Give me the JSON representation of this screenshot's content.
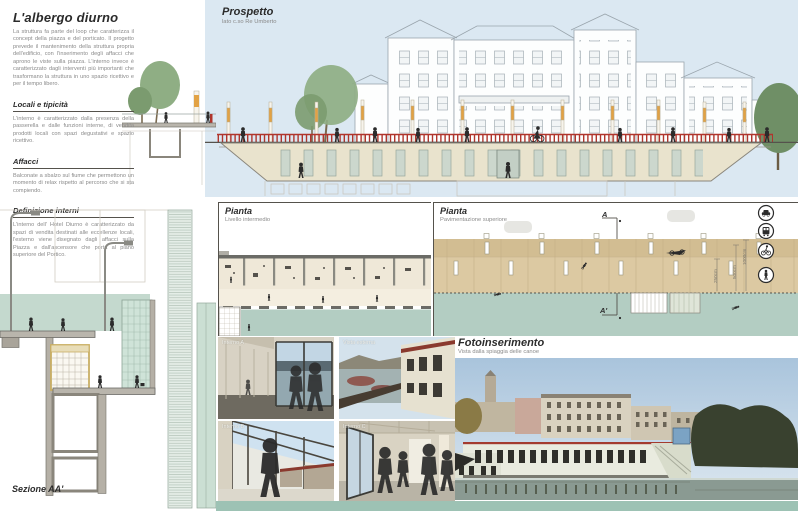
{
  "palette": {
    "sky": "#dbe8f2",
    "accent_red": "#b0352c",
    "deck_tan": "#d6c298",
    "building_beige": "#e9e3cd",
    "water_green": "#b3cdc2",
    "footer_teal": "#9dc2b4",
    "post_orange": "#e2a244",
    "silhouette": "#2b2b2b"
  },
  "left_column": {
    "title": "L'albergo diurno",
    "intro": "La struttura fa parte del loop che caratterizza il concept della piazza e del porticato. Il progetto prevede il mantenimento della struttura propria dell'edificio, con l'inserimento degli affacci che aprono le viste sulla piazza. L'interno invece è caratterizzato dagli interventi più importanti che trasformano la struttura in uno spazio ricettivo e per il tempo libero.",
    "sections": [
      {
        "heading": "Locali e tipicità",
        "body": "L'interno è caratterizzato dalla presenza della passerella e dalle funzioni interne, di vendita prodotti locali con spazi degustativi e spazio ricettivo."
      },
      {
        "heading": "Affacci",
        "body": "Balconate a sbalzo sul fiume che permettono un momento di relax rispetto al percorso che si sta compiendo."
      },
      {
        "heading": "Definizione interni",
        "body": "L'interno dell' Hotel Diurno è caratterizzato da spazi di vendita destinati alle eccellenze locali, l'esterno viene disegnato dagli affacci sulla Piazza e dall'ascensore che porta al piano superiore del Portico."
      }
    ]
  },
  "prospetto": {
    "title": "Prospetto",
    "subtitle": "lato c.so Re Umberto"
  },
  "pianta_intermedio": {
    "title": "Pianta",
    "subtitle": "Livello intermedio"
  },
  "pianta_superiore": {
    "title": "Pianta",
    "subtitle": "Pavimentazione superiore",
    "section_marker_start": "A",
    "section_marker_end": "A'",
    "dimensions": [
      "250cm",
      "500cm",
      "1000cm"
    ],
    "transport_icons": [
      "car",
      "tram",
      "bicycle",
      "pedestrian"
    ]
  },
  "sezione": {
    "label": "Sezione AA'"
  },
  "photos": [
    {
      "label": "Interno A"
    },
    {
      "label": "Vista esterna"
    },
    {
      "label": "Interno B"
    },
    {
      "label": "Interno C"
    }
  ],
  "fotoinserimento": {
    "title": "Fotoinserimento",
    "subtitle": "Vista dalla spiaggia delle canoe"
  }
}
